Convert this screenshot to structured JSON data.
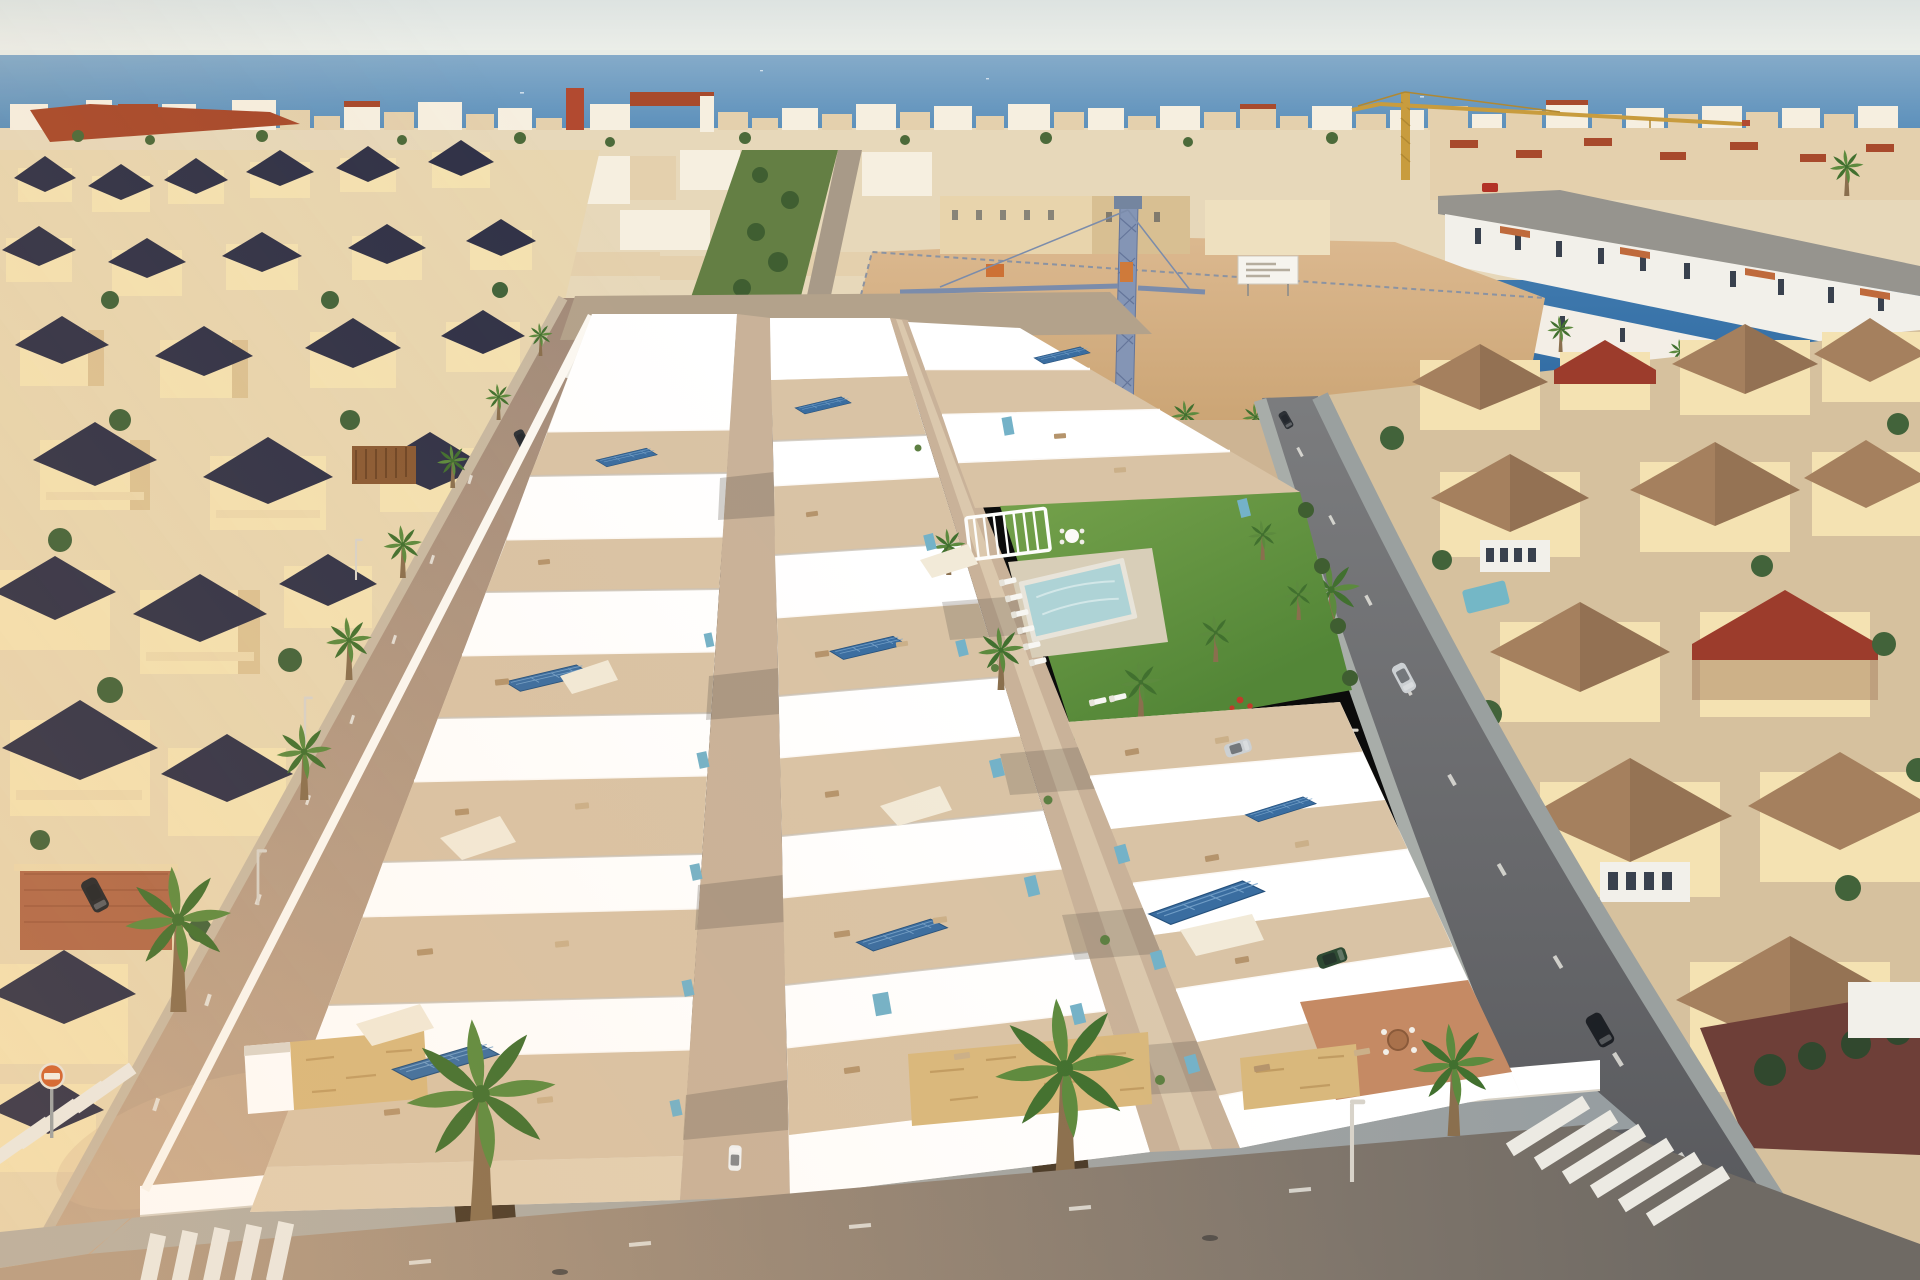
{
  "meta": {
    "title": "Aerial drone render of a new seaside villa development at golden hour",
    "type": "photograph-render",
    "visible_text": []
  },
  "palette": {
    "sky_top": "#dde3e1",
    "sky_bottom": "#eef0ea",
    "sea_light": "#85abc9",
    "sea_mid": "#4d86b6",
    "sea_deep": "#2e69a2",
    "distant_white": "#f6efe0",
    "distant_wall": "#e7d8ba",
    "distant_tan": "#e4d0ad",
    "red_roof": "#a84a2c",
    "tree_green": "#4c6a3a",
    "palm_green": "#5c8a3e",
    "palm_dark": "#41702f",
    "trunk": "#8a6f4e",
    "sand_light": "#dcb990",
    "sand_deep": "#c9a271",
    "crane_yellow": "#c89c3e",
    "crane_blue": "#8495b5",
    "crane_blue_dark": "#64759a",
    "cabin_orange": "#cd7135",
    "billboard": "#f6f4ee",
    "cream_wall": "#f4e2b2",
    "cream_shade": "#dcc293",
    "navy_roof": "#303248",
    "terrace_red": "#b06848",
    "dev_white": "#ffffff",
    "terrace": "#d9c3a5",
    "walkway": "#c9b299",
    "furniture": "#b5946c",
    "sail": "#f2ead8",
    "solar": "#3a6da0",
    "solar_line": "#7aa6cc",
    "teal_glass": "#74b2c8",
    "lawn_light": "#74a14b",
    "lawn_deep": "#538637",
    "pool": "#8fc0c8",
    "pool_light": "#aed3d6",
    "stone": "#d9b87c",
    "tile_roof": "#a5805e",
    "gable_red": "#9c3c2c",
    "sunroom": "#f2f0ea",
    "window_dark": "#39414e",
    "ground_right": "#d6c19e",
    "brick_wall": "#6e3f38",
    "road_warm": "#a8937f",
    "road_cool": "#7b7c7e",
    "sidewalk": "#9aa1a4",
    "stripe": "#eceae3",
    "sign_orange": "#d2622e",
    "car_dark": "#23262b",
    "car_silver": "#ccd0d3",
    "car_white": "#eff1f1",
    "car_green": "#2e4a33",
    "car_red": "#b23226"
  },
  "scene": {
    "sky": {
      "label": "pale hazy evening sky"
    },
    "sea": {
      "label": "deep blue sea with flat horizon and tiny white boats"
    },
    "skyline": {
      "label": "dense coastal town skyline",
      "features": [
        "white and cream low-rise blocks",
        "scattered red tile roofs",
        "red tower",
        "yellow tower crane with long jib",
        "green tree rows"
      ]
    },
    "construction_lot": {
      "label": "sandy vacant construction lot",
      "features": [
        "blue lattice tower crane",
        "white billboard on posts",
        "orange site cabin",
        "row of young palms",
        "beige apartment blocks behind"
      ]
    },
    "development": {
      "label": "three stepped rows of new white villas with roof terraces",
      "features": [
        "blue rooftop solar panels",
        "teal glass balustrades",
        "beige terrace floors with outdoor furniture",
        "shade sails",
        "stone-clad street facades",
        "white perimeter wall",
        "paver sidewalk with planted palms"
      ]
    },
    "communal_garden": {
      "label": "communal lawn garden",
      "features": [
        "turquoise swimming pool",
        "white sun loungers",
        "white pergola bench",
        "palm planting",
        "red flowering shrub"
      ]
    },
    "left_neighborhood": {
      "label": "older cream villas with dark navy pyramid roofs",
      "features": [
        "stone parapets",
        "terracotta patio",
        "wood pergola",
        "palm-lined avenue"
      ]
    },
    "right_neighborhood": {
      "label": "cream villas with mottled terracotta hipped roofs",
      "features": [
        "white glazed conservatories",
        "dark red gable roofs",
        "small private pool",
        "brick boundary wall",
        "green garden trees"
      ]
    },
    "streets": {
      "label": "surrounding streets at golden hour",
      "features": [
        "zebra crosswalks",
        "dashed lane markings",
        "slim street lamps",
        "orange no-entry sign"
      ],
      "cars": [
        "black car parked on left avenue",
        "dark car near top crossroads",
        "white car by top crosswalk",
        "silver car driving on right street",
        "black car parked bottom right",
        "red car on far right road",
        "silver car in villa driveway",
        "dark green car in driveway",
        "white car on inner lane"
      ]
    }
  }
}
